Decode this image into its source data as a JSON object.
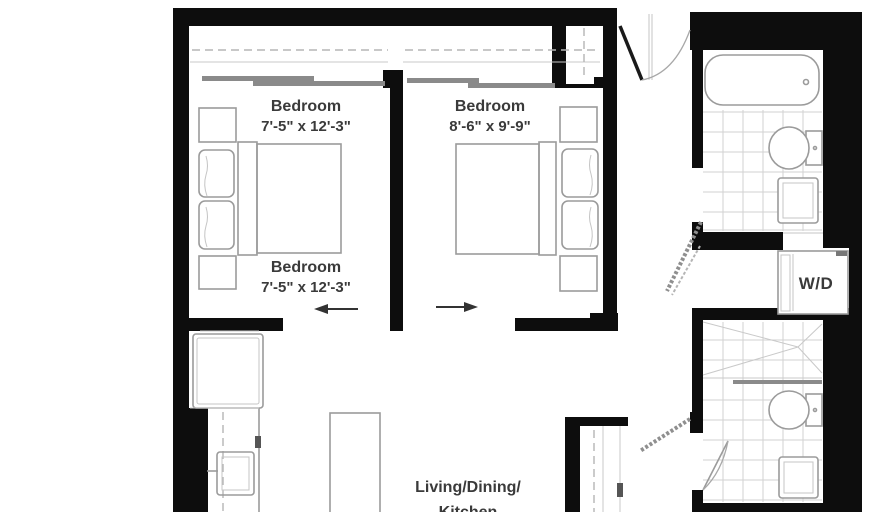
{
  "rooms": {
    "bedroom1_top": {
      "name": "Bedroom",
      "dims": "7'-5\" x 12'-3\""
    },
    "bedroom1_bottom": {
      "name": "Bedroom",
      "dims": "7'-5\" x 12'-3\""
    },
    "bedroom2": {
      "name": "Bedroom",
      "dims": "8'-6\" x 9'-9\""
    },
    "living": {
      "line1": "Living/Dining/",
      "line2": "Kitchen"
    },
    "laundry": {
      "label": "W/D"
    }
  },
  "colors": {
    "wall": "#0d0d0d",
    "fixture": "#9b9b9b",
    "tile": "#d2d2d2",
    "dashline": "#b5b5b5",
    "text": "#3a3a3a"
  }
}
